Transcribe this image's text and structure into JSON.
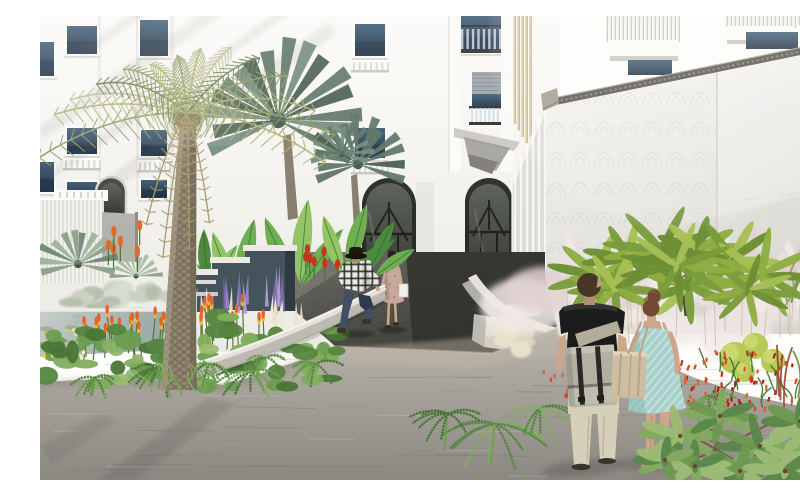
{
  "scene": {
    "title": "Architectural rendering of a landscaped courtyard entrance",
    "description": "Sun-washed rendering of a white apartment building with two arched entry doors, box balconies and a tall privacy wall. A date palm and fan palms rise over a tropical bed with banana leaves, purple and orange flower spikes and a small lily pond. A dark asphalt ramp leads to the doors where a woman in a floral dress walks out; a man in a plaid shirt steps on a curved white planter wall. In the foreground a couple holding hands walks away on light stone paving past pampas grass, an umbrella tree, red crocosmia and glossy green foliage."
  },
  "palette": {
    "facade": "#f4f2ee",
    "facadeShade": "#e6e3dd",
    "frameWhite": "#fafaf7",
    "pilaster": "#e9e6e0",
    "winGlassTop": "#3d5a74",
    "winGlassDark": "#1c2f42",
    "shutter": "#9aa1a7",
    "railDark": "#2e2c29",
    "baluster": "#d9d7d0",
    "finBeige": "#d8c9a0",
    "finShade": "#b3a37a",
    "corbelLight": "#cbc8c1",
    "corbelDark": "#97948e",
    "archFrame": "#2a2b26",
    "archGlassTop": "#5a5f55",
    "archGlassDark": "#2f312b",
    "archLite": "#767b6e",
    "wallWhite": "#f3f2ee",
    "wallShade": "#dedcd6",
    "coping": "#55514a",
    "copingTick": "#8a8578",
    "capGray": "#a09a90",
    "fluteLight": "#f6f5f2",
    "fluteShade": "#dfddd8",
    "ribLight": "#f2f1ed",
    "ribShade": "#e2e0da",
    "grayPatch": "#b4b2ad",
    "ramp1": "#6e6d66",
    "ramp2": "#393935",
    "rampWedge": "#7b7a72",
    "rampShadow": "#2e2e2a",
    "curb": "#8b887f",
    "pave1": "#bab5ac",
    "pave2": "#8b8882",
    "paveLine": "#6e6b64",
    "paveLight": "#cfc9bf",
    "tanBand": "#bfb6a6",
    "planterWall": "#e4e1da",
    "planterFace": "#bdbab2",
    "railStrip": "#3a3a36",
    "pondHi": "#c6cec9",
    "pondLo": "#97a7a6",
    "pondRim": "#ecebe4",
    "padGreen": "#aebdb2",
    "padLight": "#c6cfc2",
    "trunk": "#90866f",
    "trunkShade": "#6e6455",
    "trunkHi": "#aba08b",
    "fiber": "#8a7a55",
    "frondOlive": "#8e9a63",
    "frondLight": "#aab173",
    "frondPale": "#bcbd92",
    "frondDark": "#6f7d4e",
    "frondDead": "#a59a6c",
    "fanPalm": "#5a7263",
    "fanPalmDark": "#43594b",
    "fanPalmLight": "#6f877a",
    "fanSilver": "#8aa08b",
    "banana1": "#6fae53",
    "banana2": "#93c467",
    "banana3": "#4c8a3e",
    "bananaDark": "#2f6a28",
    "cannaRed": "#c5361f",
    "cannaOrange": "#e06a28",
    "boxSlate": "#44535c",
    "boxSlateDark": "#2e3b42",
    "boxCap": "#eceae4",
    "purple1": "#9a86c4",
    "purple2": "#b29fd4",
    "purple3": "#7f6daa",
    "cream1": "#e9e4cc",
    "cream2": "#f0ecd8",
    "silver1": "#c9d0c2",
    "silver2": "#d8ded1",
    "silver3": "#b5bdac",
    "kniStem": "#57763f",
    "kniTip": "#e4632a",
    "kniBase": "#efb43e",
    "ground1": "#55863f",
    "ground2": "#6b9d4f",
    "ground3": "#7fae5d",
    "ground4": "#497637",
    "hosta": "#9cbb6d",
    "tuft": "#7aa055",
    "skin": "#cda68c",
    "skinShade": "#b58c72",
    "hairBrown": "#473728",
    "hairAuburn": "#714832",
    "tee": "#1c1c1c",
    "teeHi": "#3a3a38",
    "strap": "#b3ac9a",
    "bag": "#b2b0a2",
    "bagFlap": "#bfbdb0",
    "bagDark": "#2a2825",
    "pants": "#d6cfba",
    "pantsShade": "#b8b09a",
    "sandals": "#39332b",
    "dress": "#a7d2cc",
    "dressShade": "#7fb5b0",
    "dressHi": "#cfe8e2",
    "tote": "#cfbda2",
    "toteShade": "#b7a488",
    "toteHi": "#e2d4ba",
    "plaidBase": "#e9e8e3",
    "plaidLine": "#262626",
    "jeans": "#3f4f66",
    "jeansDark": "#2d3a4e",
    "hatBlack": "#1c1915",
    "floralDress": "#c8a89a",
    "floralDot": "#8f5f55",
    "whiteBag": "#efefe9",
    "distantHair": "#2a211c",
    "cream3": "#dcd8c2",
    "sage": "#c9cba8",
    "pampas1": "#ece2e2",
    "pampas2": "#e2d2d4",
    "pampas3": "#d9c8cb",
    "pampas4": "#f2ebe8",
    "pampasStem": "#c9bda8",
    "umb1": "#8fae42",
    "umb2": "#7a9c3a",
    "umb3": "#a6bf55",
    "umb4": "#6d8f33",
    "umbTrunk": "#4a4034",
    "lime": "#b7ca58",
    "limeHi": "#ccdb72",
    "red1": "#c23018",
    "red2": "#d34724",
    "red3": "#a5260e",
    "red4": "#e05a2e",
    "blade": "#3f7032",
    "rGrass1": "#9a4a2e",
    "rGrass2": "#b05836",
    "rGrass3": "#6f8a42",
    "schef1": "#6f9852",
    "schef2": "#82aa60",
    "schef3": "#5a874a",
    "schef4": "#9cba74",
    "schefDot": "#7a3a2a",
    "shadow": "#3c3b38",
    "sun": "#ffffff"
  }
}
